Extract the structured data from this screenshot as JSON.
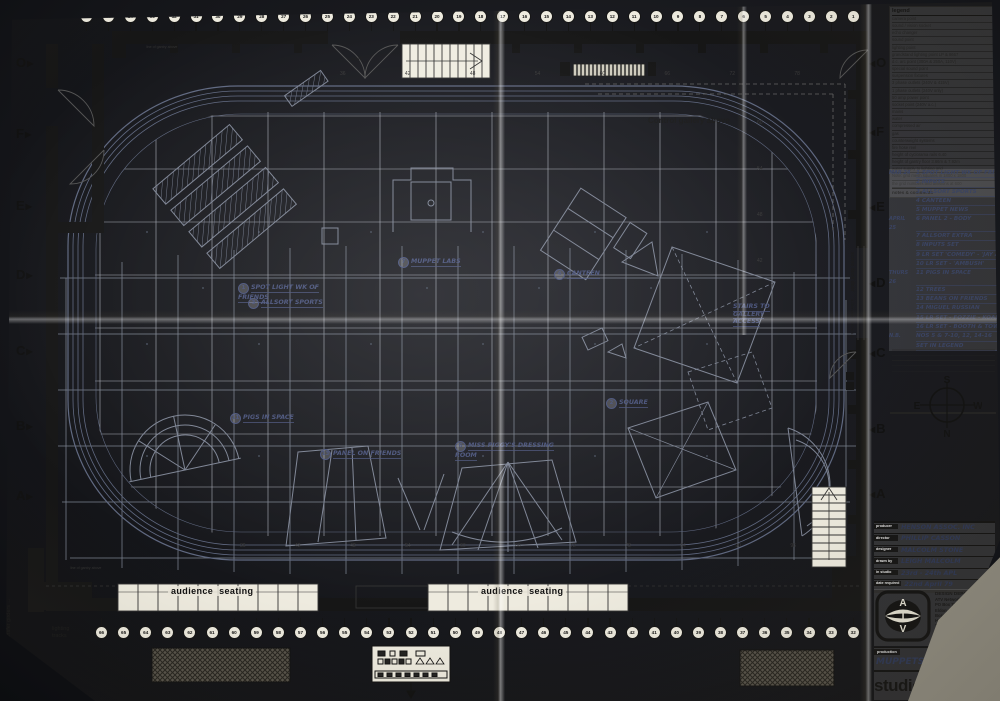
{
  "labels": {
    "lighting_tracks_arrow": "lighting tracks →",
    "lighting_tracks_line1": "lighting",
    "lighting_tracks_line2": "tracks",
    "transfer_girders": "transfer girders →",
    "control_gallery": "Control  gallery  above",
    "exit": "exit",
    "scene_dock_door": "scene dock door",
    "scene_dock_dims": "4.26m wide x 4.57m high",
    "audience_seating": "audience  seating",
    "line_of_gantry": "line of gantry above"
  },
  "grid": {
    "letters_left": [
      {
        "label": "O",
        "y": 56
      },
      {
        "label": "F",
        "y": 127
      },
      {
        "label": "E",
        "y": 199
      },
      {
        "label": "D",
        "y": 268
      },
      {
        "label": "C",
        "y": 344
      },
      {
        "label": "B",
        "y": 419
      },
      {
        "label": "A",
        "y": 489
      }
    ],
    "letters_right": [
      {
        "label": "O",
        "y": 56
      },
      {
        "label": "F",
        "y": 125
      },
      {
        "label": "E",
        "y": 200
      },
      {
        "label": "D",
        "y": 276
      },
      {
        "label": "C",
        "y": 346
      },
      {
        "label": "B",
        "y": 422
      },
      {
        "label": "A",
        "y": 487
      }
    ],
    "numbers_top": [
      "36",
      "42",
      "48",
      "54",
      "60",
      "66",
      "72",
      "78"
    ],
    "numbers_bottom": [
      "36",
      "42",
      "48",
      "54",
      "60",
      "66",
      "72",
      "78",
      "84",
      "90",
      "96"
    ],
    "numbers_right": [
      {
        "label": "60",
        "y": 120
      },
      {
        "label": "54",
        "y": 166
      },
      {
        "label": "48",
        "y": 212
      },
      {
        "label": "42",
        "y": 258
      }
    ]
  },
  "tracks": {
    "top": [
      "36",
      "35",
      "34",
      "33",
      "32",
      "31",
      "30",
      "29",
      "28",
      "27",
      "26",
      "25",
      "24",
      "23",
      "22",
      "21",
      "20",
      "19",
      "18",
      "17",
      "16",
      "15",
      "14",
      "13",
      "12",
      "11",
      "10",
      "9",
      "8",
      "7",
      "6",
      "5",
      "4",
      "3",
      "2",
      "1"
    ],
    "bottom": [
      "66",
      "65",
      "64",
      "63",
      "62",
      "61",
      "60",
      "59",
      "58",
      "57",
      "56",
      "55",
      "54",
      "53",
      "52",
      "51",
      "50",
      "49",
      "48",
      "47",
      "46",
      "45",
      "44",
      "43",
      "42",
      "41",
      "40",
      "39",
      "38",
      "37",
      "36",
      "35",
      "34",
      "33",
      "32"
    ]
  },
  "annotations": [
    {
      "x": 238,
      "y": 283,
      "num": "1",
      "text": "SPOT LIGHT WK OF FRIENDS"
    },
    {
      "x": 248,
      "y": 298,
      "num": "3",
      "text": "ALLSORT SPORTS"
    },
    {
      "x": 398,
      "y": 257,
      "num": "7",
      "text": "MUPPET LABS"
    },
    {
      "x": 554,
      "y": 269,
      "num": "4",
      "text": "CANTEEN"
    },
    {
      "x": 606,
      "y": 398,
      "num": "2",
      "text": "SQUARE"
    },
    {
      "x": 230,
      "y": 413,
      "num": "11",
      "text": "PIGS IN SPACE"
    },
    {
      "x": 320,
      "y": 449,
      "num": "13",
      "text": "PANEL ON FRIENDS"
    },
    {
      "x": 455,
      "y": 441,
      "num": "6",
      "text": "MISS PIGGY'S DRESSING ROOM"
    },
    {
      "x": 733,
      "y": 303,
      "num": "",
      "text": "STAIRS TO GALLERY ACCESS",
      "w": 58
    }
  ],
  "panel": {
    "legend": {
      "title": "legend",
      "rows": [
        "camera point",
        "sound / vision socket",
        "echo changer",
        "sound point",
        "lighting point",
        "grandstand lighting point LP & 8667",
        "d.c. arc point (300A & 250A, 110V)",
        "special sound point",
        "suspension fixtures",
        "3 phase outlets (240V & 415V)",
        "1 phase outlets (240V only)",
        "50 amp power point",
        "socket point (240V a.c.)",
        "mains",
        "water",
        "compressed air",
        "gas",
        "counterweight systems",
        "fire hose reel",
        "height of cyclorama rails 6.40",
        "height of gantry floor 3.66m & 7.92m",
        "water supply to lighting grid",
        "Note: grid mesh squares in 1800 x 1800",
        "the grid numbers and divisions at 600"
      ],
      "footer": "notes & comments"
    },
    "notes": [
      {
        "h": "MAR 24",
        "t": "1  SPOT LIGHT WK OF FRIENDS"
      },
      {
        "h": "",
        "t": "2  INPUTS"
      },
      {
        "h": "",
        "t": "3  ALLSORT SPORTS"
      },
      {
        "h": "",
        "t": "4  CANTEEN"
      },
      {
        "h": "",
        "t": "5  MUPPET NEWS"
      },
      {
        "h": "APRIL 25",
        "t": "6  PANEL 2 - BODY"
      },
      {
        "h": "",
        "t": "7  ALLSORT EXTRA"
      },
      {
        "h": "",
        "t": "8  INPUTS SET"
      },
      {
        "h": "",
        "t": "9  LR SET 'COMEDY' - 'JAY ANDERSON'"
      },
      {
        "h": "",
        "t": "10  LR SET - 'AMBUSH'"
      },
      {
        "h": "THURS 26",
        "t": "11  PIGS IN SPACE"
      },
      {
        "h": "",
        "t": "12  TREES"
      },
      {
        "h": "",
        "t": "13  BEANS ON FRIENDS"
      },
      {
        "h": "",
        "t": "14  MIGUEL RUSSIAN"
      },
      {
        "h": "",
        "t": "15  LR SET - FOZZIE - KOALA"
      },
      {
        "h": "",
        "t": "16  LR SET - BOOTH & TOWER"
      },
      {
        "h": "N.B.",
        "t": "NOS 5 & 7-10, 12, 14-16"
      },
      {
        "h": "",
        "t": "SET IN LEGEND"
      }
    ],
    "compass": {
      "n": "N",
      "s": "S",
      "e": "E",
      "w": "W"
    },
    "titleblock": [
      {
        "label": "producer",
        "value": "HENSON ASSOC. INC"
      },
      {
        "label": "director",
        "value": "PHILLIP CASSON"
      },
      {
        "label": "designer",
        "value": "MALCOLM STONE"
      },
      {
        "label": "drawn by",
        "value": "LEIGH MALCOLM"
      },
      {
        "label": "in studio",
        "value": "23rd - 24th APL"
      },
      {
        "label": "date required",
        "value": "22nd April 79"
      }
    ],
    "atv": {
      "l1": "A",
      "l2": "T",
      "l3": "V",
      "dept": "DESIGN DEPARTMENT",
      "address": [
        "ATV Network Ltd",
        "PO Box 70",
        "Eldon Avenue",
        "Boreham Wood",
        "Herts WD6 1JF",
        "Tel 01-953 6100",
        "extension"
      ]
    },
    "production": {
      "label": "production",
      "value": "MUPPETS (72)",
      "number_label": "number",
      "number": "5377"
    },
    "studio": {
      "name": "studio D",
      "scale_label": "scale",
      "scale": "1:50"
    }
  }
}
